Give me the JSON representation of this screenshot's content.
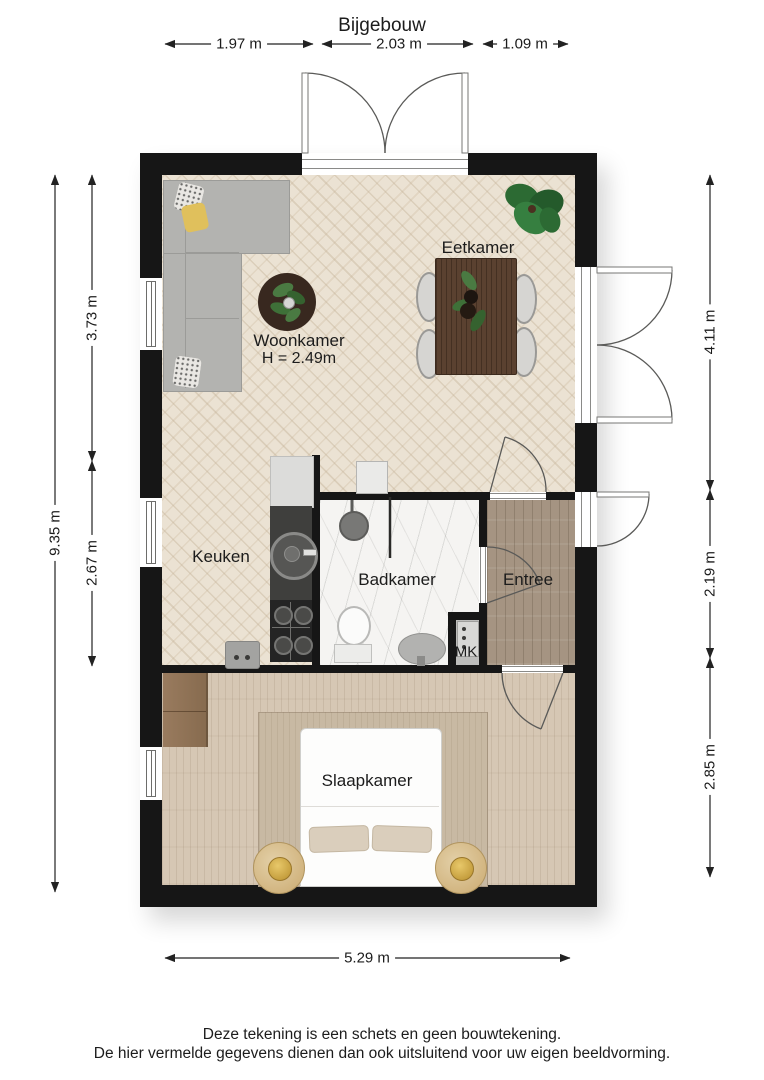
{
  "title": "Bijgebouw",
  "dims": {
    "top_left": "1.97 m",
    "top_mid": "2.03 m",
    "top_right": "1.09 m",
    "left_total": "9.35 m",
    "left_upper": "3.73 m",
    "left_lower": "2.67 m",
    "right_upper": "4.11 m",
    "right_middle": "2.19 m",
    "right_lower": "2.85 m",
    "bottom": "5.29 m"
  },
  "rooms": {
    "eetkamer": "Eetkamer",
    "woonkamer": "Woonkamer",
    "woonkamer_ceiling": "H = 2.49m",
    "keuken": "Keuken",
    "badkamer": "Badkamer",
    "entree": "Entree",
    "mk": "MK",
    "slaapkamer": "Slaapkamer"
  },
  "footer": {
    "line1": "Deze tekening is een schets en geen bouwtekening.",
    "line2": "De hier vermelde gegevens dienen dan ook uitsluitend voor uw eigen beeldvorming."
  },
  "colors": {
    "wall": "#161616",
    "floor_living": "#ebe2d3",
    "floor_bedroom": "#d6c7b4",
    "floor_entree": "#a59482",
    "floor_bath": "#f5f4f2",
    "table_wood": "#5a4130",
    "plant_green": "#2e6b34"
  }
}
